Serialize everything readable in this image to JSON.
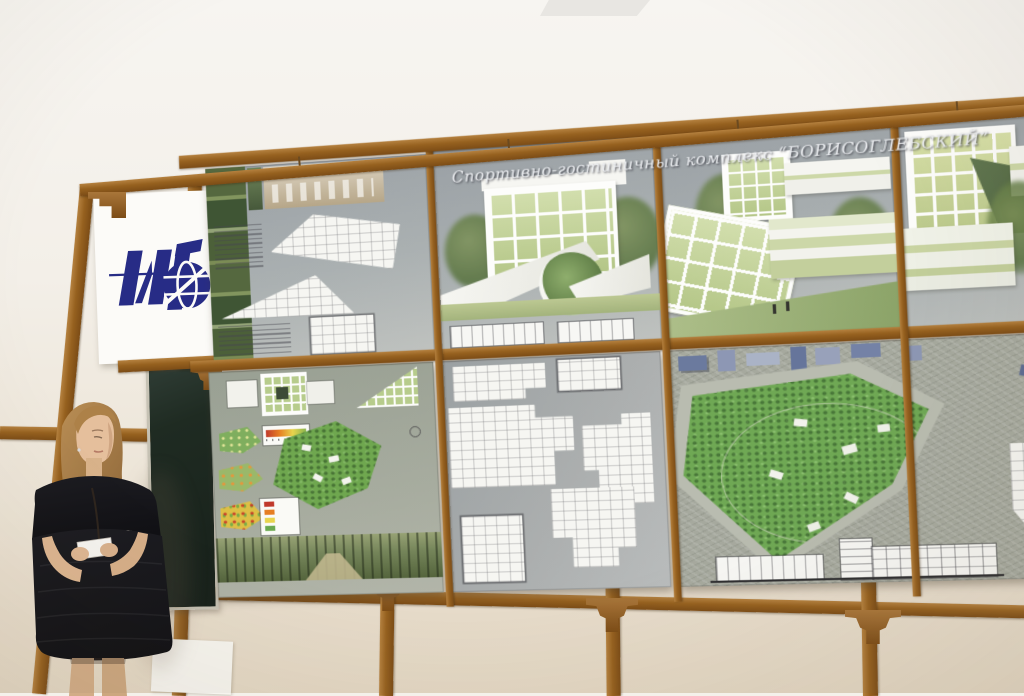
{
  "scene": {
    "type": "photograph",
    "setting": "exhibition room: presenter beside wooden trellis frame holding architectural competition boards",
    "poster_title": "Спортивно-гостиничный комплекс “БОРИСОГЛЕБСКИЙ”",
    "logo": {
      "name": "institute-globe-logo",
      "glyphs": "ИГ",
      "color": "#272c86",
      "background": "#fcfbf8"
    },
    "presenter": {
      "description": "young woman, long light-brown hair, black cap-sleeve dress, holding white note cards",
      "position": "bottom-left"
    },
    "boards": {
      "frame_color": "#96611f",
      "panel_background": "#9ba0a3",
      "panels": [
        {
          "id": "top-left",
          "content": "forest photo column, interior photos, triangular floor plans, annotation text"
        },
        {
          "id": "top-center",
          "content": "rendering: white grid facade with green glazing, angular white wedge with circular cutout"
        },
        {
          "id": "top-center-right",
          "content": "rendering: tilted grid pavilion, pale green slab, trees"
        },
        {
          "id": "top-right",
          "content": "rendering: green grid facade volumes and white slabs"
        },
        {
          "id": "bottom-left",
          "content": "site analysis aerial, color-coded parcels, two legends, panoramic forest photo strip"
        },
        {
          "id": "bottom-center",
          "content": "white floor plans on gray field"
        },
        {
          "id": "bottom-right",
          "content": "aerial masterplan with triangular green park, building section, detail plan"
        }
      ]
    },
    "room": {
      "wall_color": "#efe9dd",
      "chalkboard_color": "#1f2b22",
      "banner_color": "#fcfbf8"
    }
  }
}
